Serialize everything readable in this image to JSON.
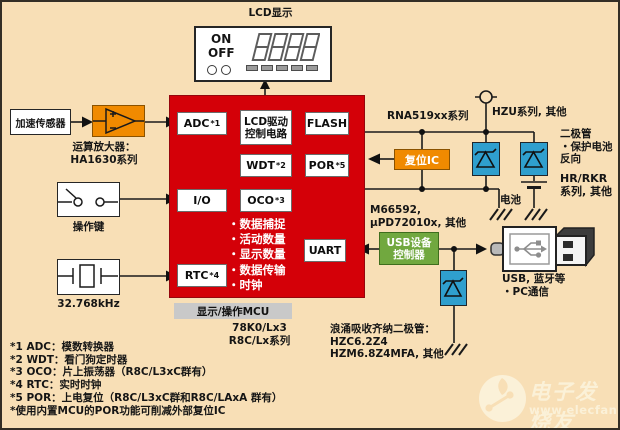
{
  "colors": {
    "background": "#f8dfb6",
    "mcu_red": "#d40008",
    "accent_orange": "#f08a00",
    "accent_green": "#71a83f",
    "diode_blue": "#2f9fce",
    "caption_gray": "#c9c9c9"
  },
  "icons": {
    "opamp-icon": "triangle amplifier symbol",
    "switch-icon": "open contact switch symbol",
    "crystal-icon": "quartz crystal symbol",
    "zener-diode-icon": "zener diode symbol",
    "battery-icon": "battery cell plates",
    "ground-icon": "hatched ground strokes",
    "supply-terminal-icon": "open circle terminal",
    "usb-plug-icon": "usb connector drawing",
    "seven-segment-icon": "8888 segment digits"
  },
  "lcd": {
    "title": "LCD显示",
    "on": "ON",
    "off": "OFF",
    "digits": "8888"
  },
  "left": {
    "sensor": "加速传感器",
    "opamp_line1": "运算放大器：",
    "opamp_line2": "HA1630系列",
    "keys": "操作键",
    "crystal": "32.768kHz"
  },
  "mcu": {
    "adc": "ADC",
    "adc_sup": "*1",
    "lcd_drive1": "LCD驱动",
    "lcd_drive2": "控制电路",
    "flash": "FLASH",
    "wdt": "WDT",
    "wdt_sup": "*2",
    "por": "POR",
    "por_sup": "*5",
    "io": "I/O",
    "oco": "OCO",
    "oco_sup": "*3",
    "rtc": "RTC",
    "rtc_sup": "*4",
    "uart": "UART",
    "features": [
      "・数据捕捉",
      "・活动数量",
      "・显示数量",
      "・数据传输",
      "・时钟"
    ],
    "caption": "显示/操作MCU",
    "family1": "78K0/Lx3",
    "family2": "R8C/Lx系列"
  },
  "right": {
    "rna": "RNA519xx系列",
    "reset_ic": "复位IC",
    "hzu": "HZU系列, 其他",
    "diode_note1": "二极管",
    "diode_note2": "・保护电池",
    "diode_note3": "反向",
    "hr_rkr1": "HR/RKR",
    "hr_rkr2": "系列, 其他",
    "battery": "电池",
    "usb_parts1": "M66592,",
    "usb_parts2": "μPD72010x, 其他",
    "usb_ctrl1": "USB设备",
    "usb_ctrl2": "控制器",
    "usb_use1": "USB, 蓝牙等",
    "usb_use2": "・PC通信",
    "zener_note1": "浪涌吸收齐纳二极管：",
    "zener_note2": "HZC6.2Z4",
    "zener_note3": "HZM6.8Z4MFA, 其他"
  },
  "footnotes": [
    "*1 ADC：模数转换器",
    "*2 WDT：看门狗定时器",
    "*3 OCO：片上振荡器（R8C/L3xC群有）",
    "*4 RTC：实时时钟",
    "*5 POR：上电复位（R8C/L3xC群和R8C/LAxA 群有）",
    "*使用内置MCU的POR功能可削减外部复位IC"
  ],
  "watermark": {
    "name": "电子发烧友",
    "url": "www.elecfans.com"
  }
}
